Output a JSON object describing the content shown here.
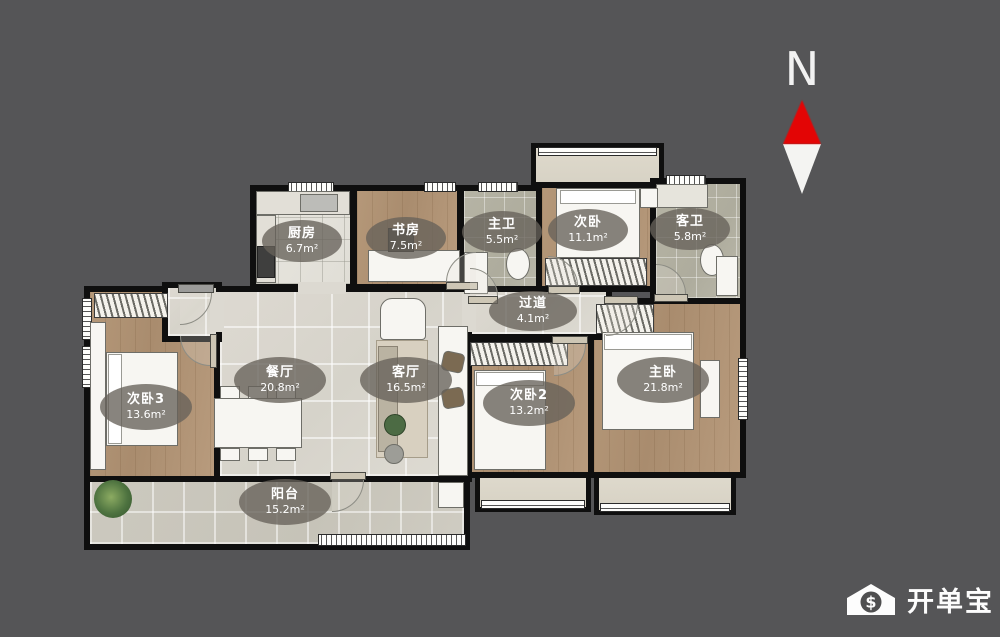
{
  "compass": {
    "label": "N",
    "icon": "north-arrow-icon"
  },
  "watermark": {
    "brand": "开单宝",
    "icon": "house-dollar-icon",
    "dollar": "$"
  },
  "rooms": {
    "kitchen": {
      "name": "厨房",
      "area": "6.7m²"
    },
    "study": {
      "name": "书房",
      "area": "7.5m²"
    },
    "master_bath": {
      "name": "主卫",
      "area": "5.5m²"
    },
    "bedroom_second": {
      "name": "次卧",
      "area": "11.1m²"
    },
    "guest_bath": {
      "name": "客卫",
      "area": "5.8m²"
    },
    "hallway": {
      "name": "过道",
      "area": "4.1m²"
    },
    "dining": {
      "name": "餐厅",
      "area": "20.8m²"
    },
    "living": {
      "name": "客厅",
      "area": "16.5m²"
    },
    "bedroom_third": {
      "name": "次卧3",
      "area": "13.6m²"
    },
    "bedroom_second2": {
      "name": "次卧2",
      "area": "13.2m²"
    },
    "master_bedroom": {
      "name": "主卧",
      "area": "21.8m²"
    },
    "balcony": {
      "name": "阳台",
      "area": "15.2m²"
    }
  },
  "colors": {
    "background": "#555557",
    "wall": "#0f0f0f",
    "wood_floor": "#b59879",
    "light_tile": "#dcd9d1",
    "bath_tile": "#b6b4a5",
    "compass_red": "#e30505",
    "label_pill": "rgba(102,98,90,0.78)"
  }
}
